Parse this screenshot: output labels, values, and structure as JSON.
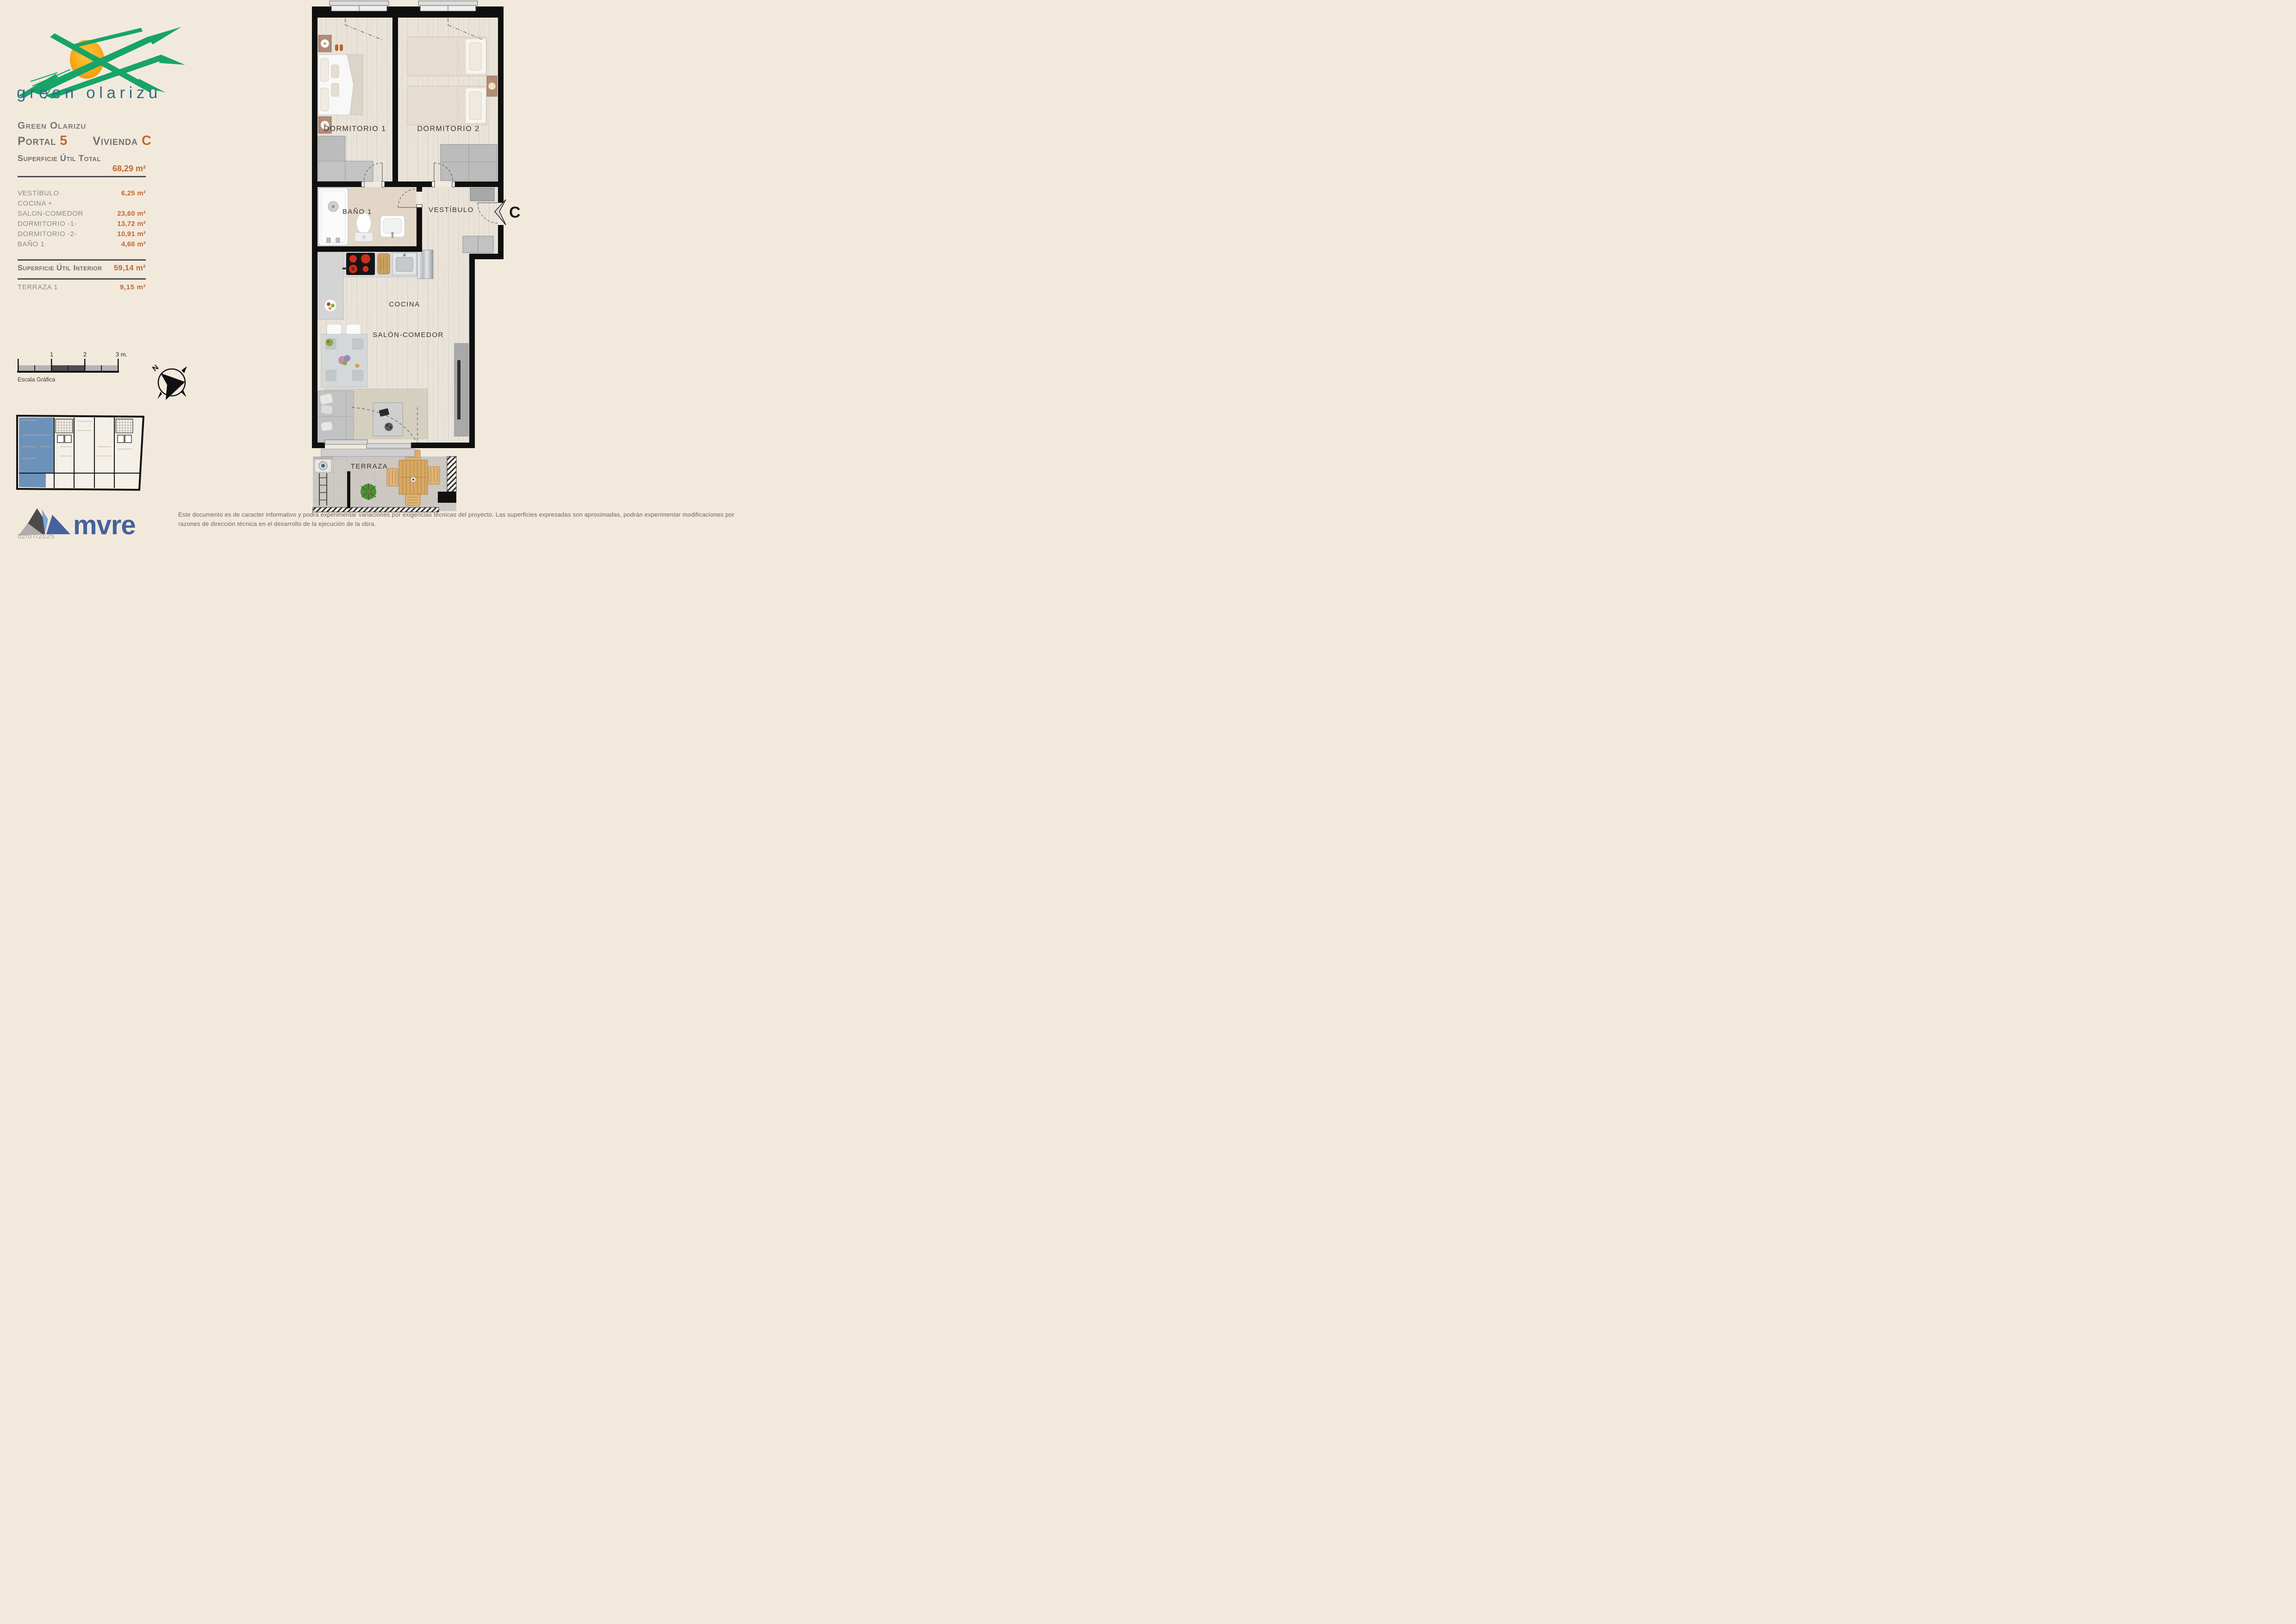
{
  "page": {
    "date": "02/07/2025"
  },
  "logo": {
    "wordmark": "green olarizu",
    "green": "#17a469",
    "sun": "#f5a800",
    "wordmark_color": "#2f6d85"
  },
  "header": {
    "project": "Green Olarizu",
    "portal_label": "Portal",
    "portal_value": "5",
    "unit_label": "Vivienda",
    "unit_value": "C"
  },
  "surface": {
    "total_label": "Superficie Útil Total",
    "total_value": "68,29 m²",
    "rows": [
      {
        "label": "VESTÍBULO",
        "value": "6,25 m²"
      },
      {
        "label": "COCINA +",
        "value": ""
      },
      {
        "label": "SALON-COMEDOR",
        "value": "23,60 m²"
      },
      {
        "label": "DORMITORIO -1-",
        "value": "13,72 m²"
      },
      {
        "label": "DORMITORIO -2-",
        "value": "10,91 m²"
      },
      {
        "label": "BAÑO 1",
        "value": "4,66 m²"
      }
    ],
    "interior_label": "Superficie Útil Interior",
    "interior_value": "59,14 m²",
    "terrace_label": "TERRAZA 1",
    "terrace_value": "9,15 m²"
  },
  "scale_bar": {
    "tick_1": "1",
    "tick_2": "2",
    "tick_3": "3 m.",
    "caption": "Escala Gráfica"
  },
  "compass": {
    "north": "N"
  },
  "plan": {
    "labels": {
      "dorm1": "DORMITORIO 1",
      "dorm2": "DORMITORIO 2",
      "bath": "BAÑO 1",
      "hall": "VESTÍBULO",
      "kitchen": "COCINA",
      "living": "SALÓN-COMEDOR",
      "terrace": "TERRAZA"
    },
    "entrance_marker": "C"
  },
  "keyplan": {
    "highlight_color": "#6d92ba"
  },
  "brand": {
    "wordmark": "mvre",
    "color": "#44639c"
  },
  "footer": {
    "line1": "Este documento es de caracter informativo y podrá experimentar variaciones por exigencias técnicas del proyecto. Las superficies expresadas son aproximadas, podrán experimentar modificaciones por",
    "line2": "razones de dirección técnica en el desarrollo de la ejecución de la obra."
  },
  "colors": {
    "accent": "#c1682f",
    "wall": "#0f0f0f",
    "background": "#f2e9dd"
  }
}
